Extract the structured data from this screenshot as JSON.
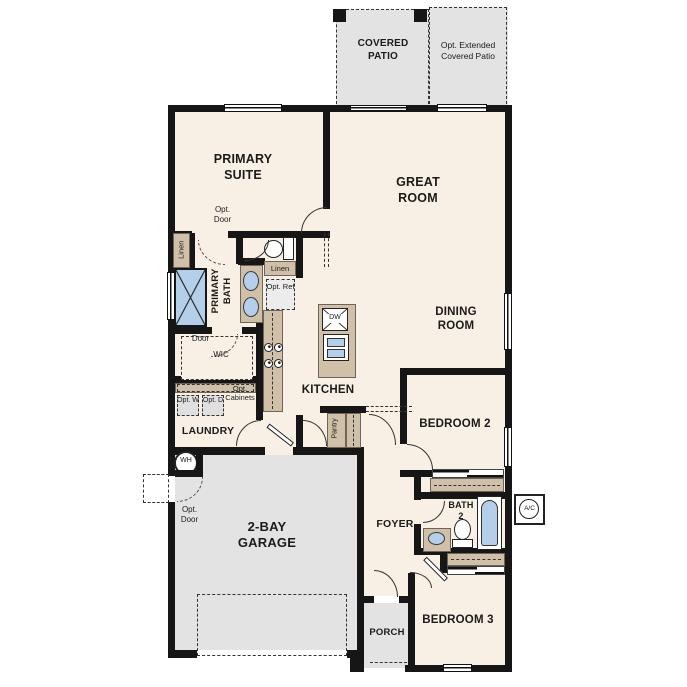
{
  "rooms": {
    "covered_patio": "COVERED PATIO",
    "opt_extended_patio": "Opt. Extended Covered Patio",
    "primary_suite": "PRIMARY SUITE",
    "great_room": "GREAT ROOM",
    "dining_room": "DINING ROOM",
    "primary_bath": "PRIMARY BATH",
    "wic": "WIC",
    "kitchen": "KITCHEN",
    "laundry": "LAUNDRY",
    "bedroom_2": "BEDROOM 2",
    "bath_2": "BATH 2",
    "foyer": "FOYER",
    "garage": "2-BAY GARAGE",
    "porch": "PORCH",
    "bedroom_3": "BEDROOM 3",
    "pantry": "Pantry"
  },
  "labels": {
    "opt_door": "Opt. Door",
    "linen": "Linen",
    "opt_ref": "Opt. Ref",
    "opt_washer": "Opt. W",
    "opt_dryer": "Opt. D",
    "opt_cabinets": "Opt. Cabinets",
    "dishwasher": "DW",
    "water_heater": "WH",
    "ac_unit": "A/C"
  },
  "colors": {
    "floor": "#f8f0e4",
    "exterior_concrete": "#e3e3e3",
    "walls": "#161616",
    "cabinetry": "#cfc0a7",
    "plumbing_fixtures": "#b3cfea"
  }
}
